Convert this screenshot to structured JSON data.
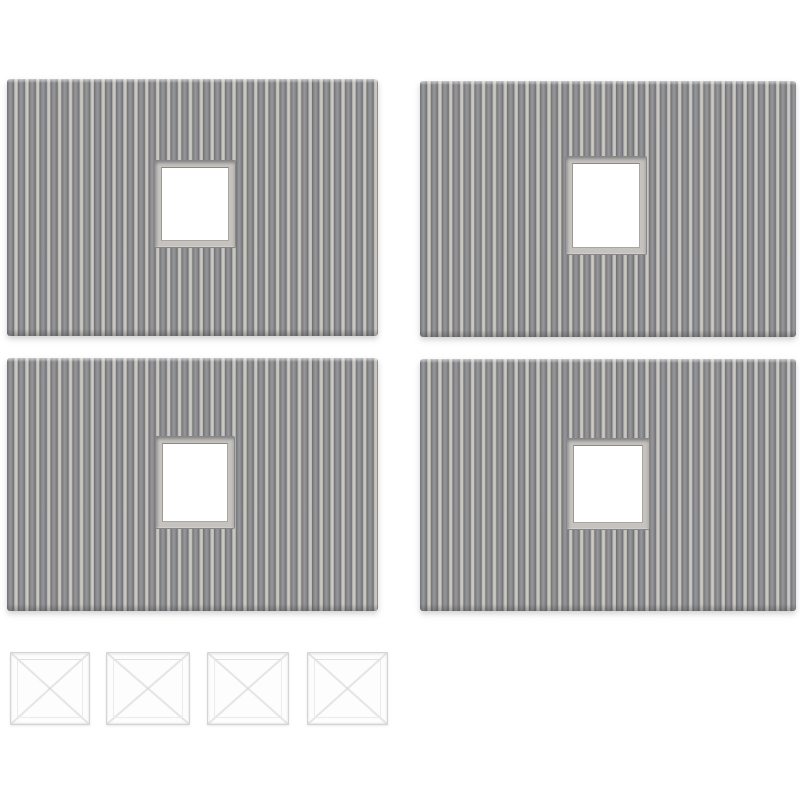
{
  "image": {
    "type": "product-photo",
    "background_color": "#ffffff",
    "description": "Four grey corrugated plastic wall panels, each with one square window opening, arranged in a 2x2 grid, with four clear plastic window glazing squares in a row below",
    "counts": {
      "panels": 4,
      "glazing_squares": 4
    }
  },
  "colors": {
    "rib_dark_edge": "#6e7073",
    "rib_dark_mid": "#98989b",
    "rib_light": "#cbc8c2",
    "window_frame": "#c6c3be",
    "window_frame_shadow": "#87878a",
    "window_opening": "#ffffff",
    "glazing_border": "#d4d4d4",
    "glazing_face": "#fdfdfd",
    "panel_shadow": "rgba(125,125,125,0.35)"
  },
  "panels": {
    "items": [
      {
        "name": "corrugated-panel-top-left",
        "x": 7,
        "y": 79,
        "w": 371,
        "h": 257,
        "window": {
          "x": 147,
          "y": 81,
          "w": 82,
          "h": 88
        }
      },
      {
        "name": "corrugated-panel-top-right",
        "x": 420,
        "y": 81,
        "w": 376,
        "h": 256,
        "window": {
          "x": 145,
          "y": 75,
          "w": 82,
          "h": 99
        }
      },
      {
        "name": "corrugated-panel-bottom-left",
        "x": 7,
        "y": 358,
        "w": 371,
        "h": 253,
        "window": {
          "x": 148,
          "y": 78,
          "w": 80,
          "h": 93
        }
      },
      {
        "name": "corrugated-panel-bottom-right",
        "x": 420,
        "y": 359,
        "w": 376,
        "h": 252,
        "window": {
          "x": 146,
          "y": 79,
          "w": 84,
          "h": 92
        }
      }
    ]
  },
  "glazing": {
    "items": [
      {
        "name": "clear-glazing-square-1",
        "x": 10,
        "y": 652,
        "w": 80,
        "h": 73
      },
      {
        "name": "clear-glazing-square-2",
        "x": 106,
        "y": 652,
        "w": 84,
        "h": 73
      },
      {
        "name": "clear-glazing-square-3",
        "x": 207,
        "y": 652,
        "w": 82,
        "h": 73
      },
      {
        "name": "clear-glazing-square-4",
        "x": 307,
        "y": 652,
        "w": 81,
        "h": 73
      }
    ]
  }
}
